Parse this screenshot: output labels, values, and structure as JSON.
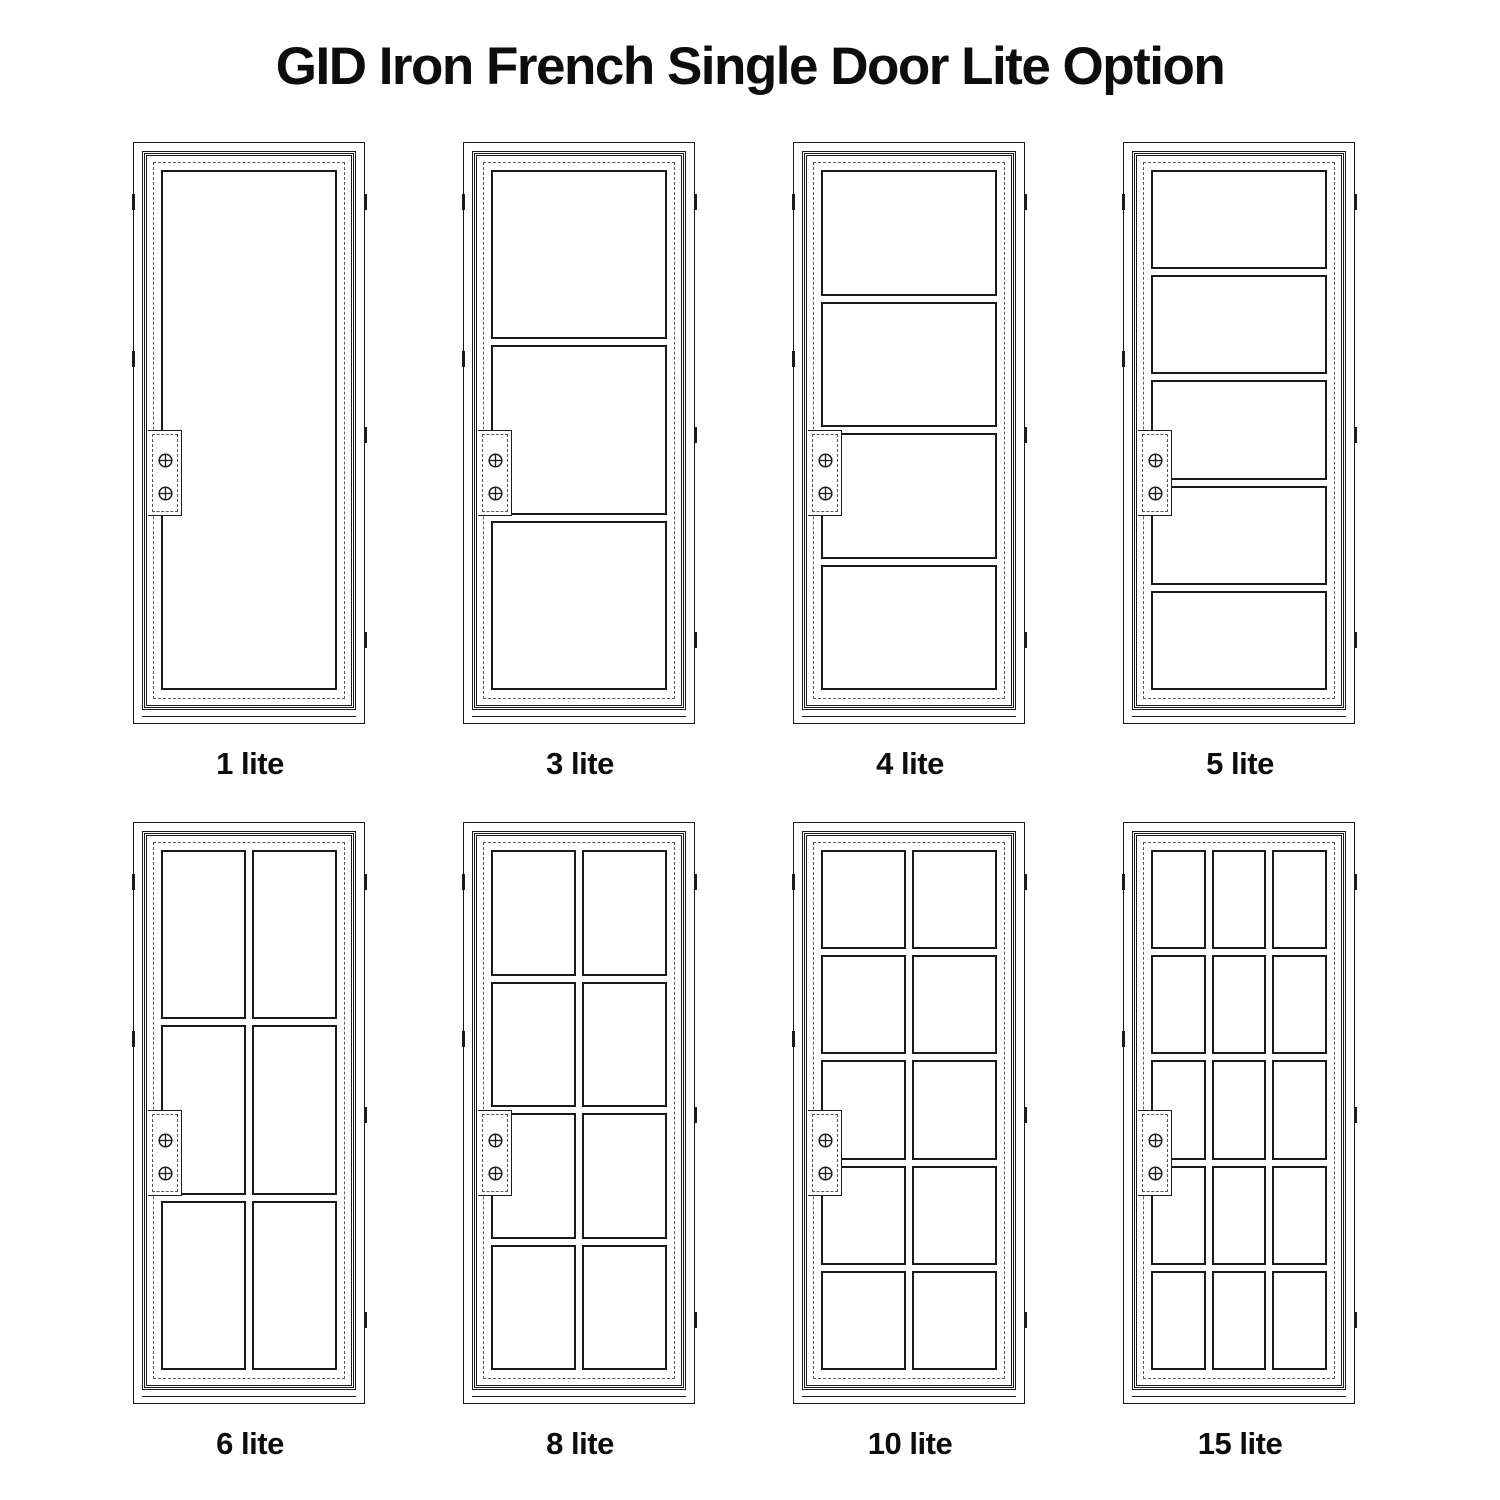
{
  "title": "GID Iron French Single Door Lite Option",
  "doors": [
    {
      "label": "1 lite",
      "cols": 1,
      "rows": 1
    },
    {
      "label": "3 lite",
      "cols": 1,
      "rows": 3
    },
    {
      "label": "4 lite",
      "cols": 1,
      "rows": 4
    },
    {
      "label": "5 lite",
      "cols": 1,
      "rows": 5
    },
    {
      "label": "6 lite",
      "cols": 2,
      "rows": 3
    },
    {
      "label": "8 lite",
      "cols": 2,
      "rows": 4
    },
    {
      "label": "10 lite",
      "cols": 2,
      "rows": 5
    },
    {
      "label": "15 lite",
      "cols": 3,
      "rows": 5
    }
  ],
  "icons": {
    "screw": "crossed-circle-screw",
    "hinge": "hinge-tick"
  },
  "colors": {
    "line": "#1a1a1a",
    "dashed_line": "#5a5a5a",
    "background": "#ffffff",
    "text": "#0d0d0d"
  }
}
